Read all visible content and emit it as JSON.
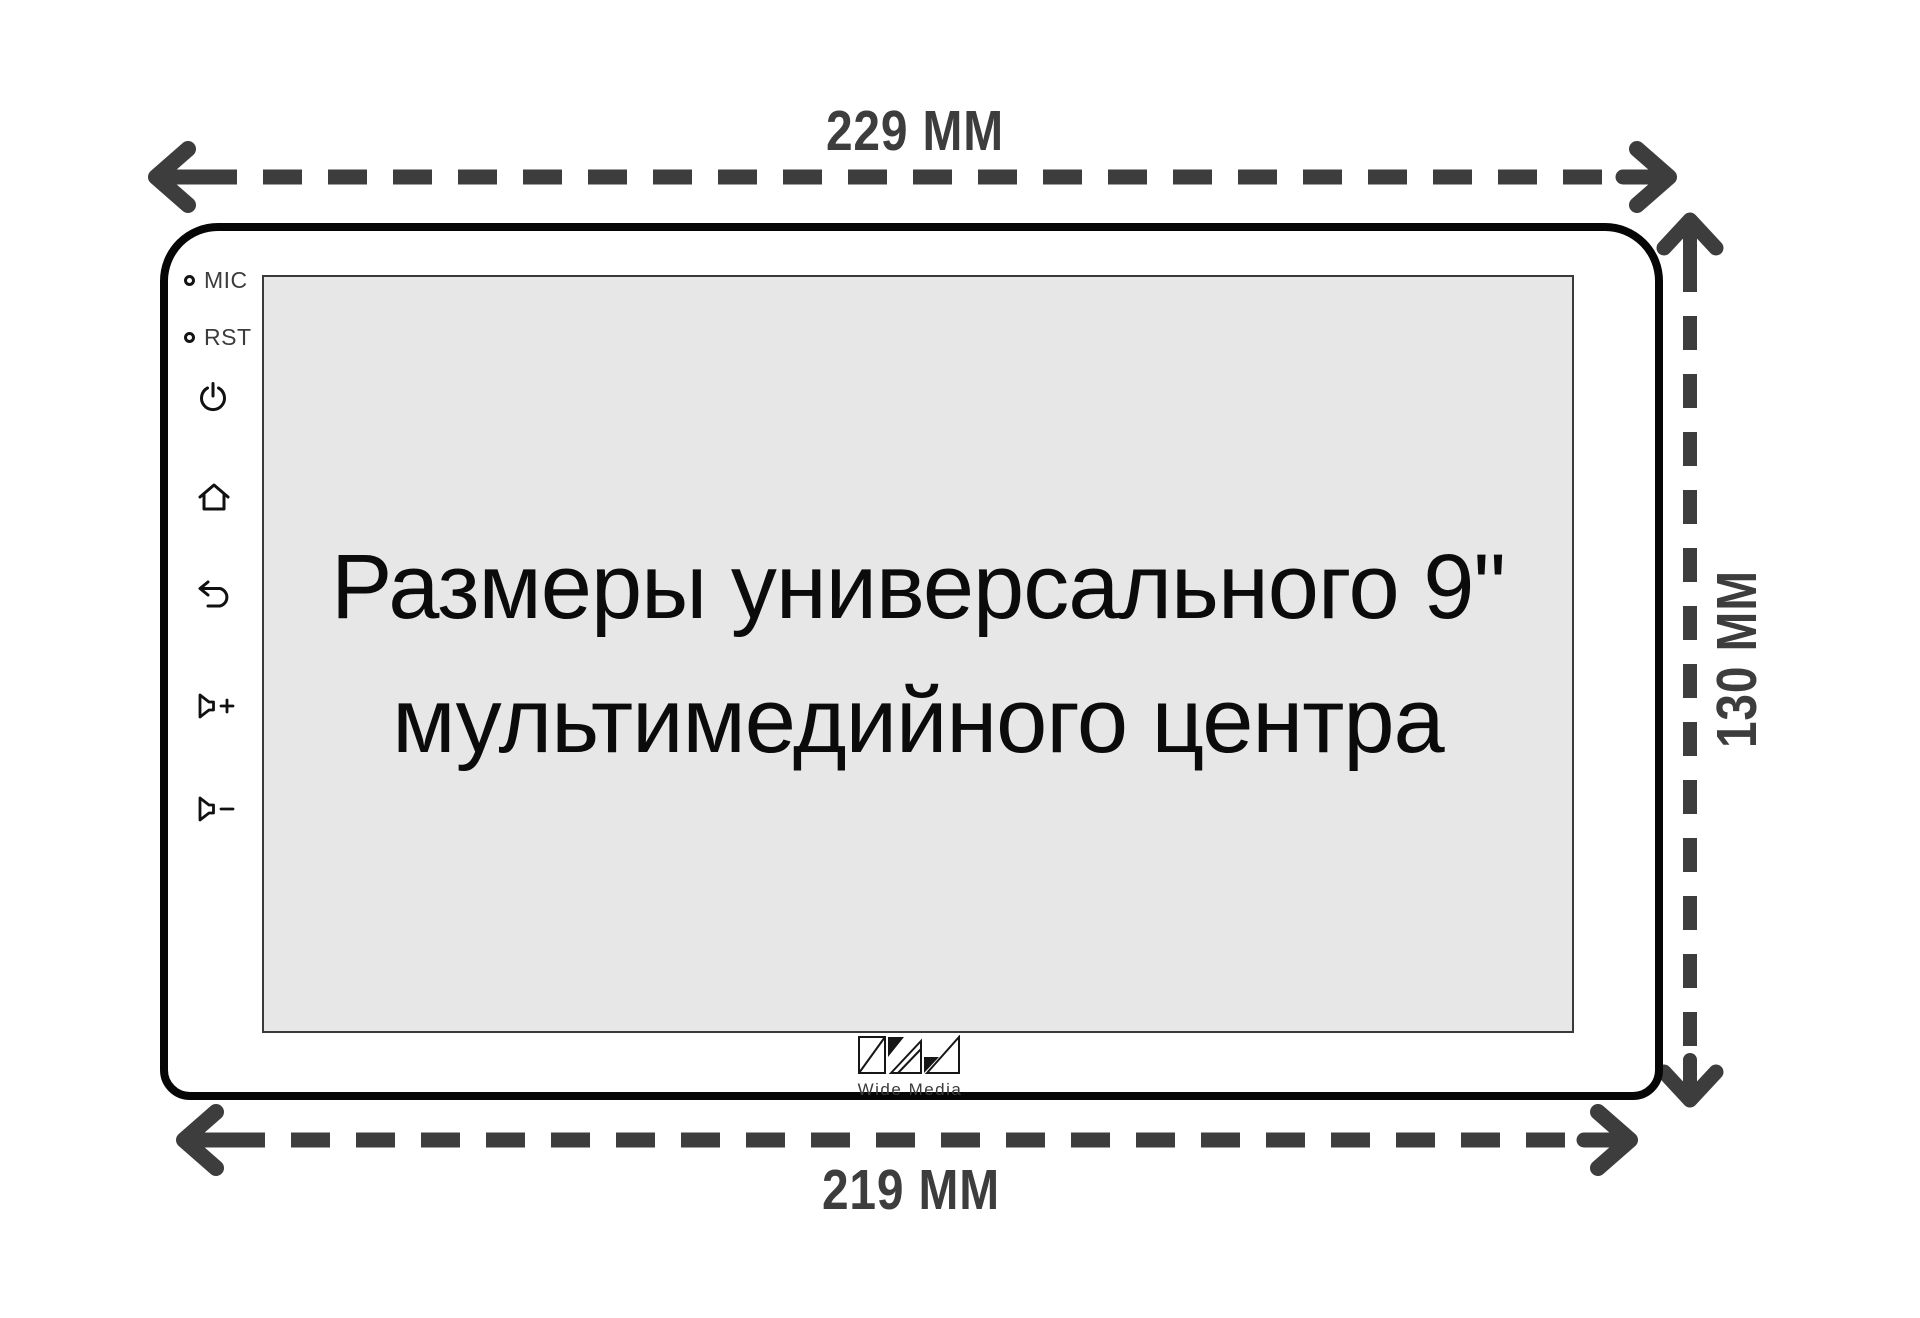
{
  "dimensions": {
    "top_label": "229 MM",
    "bottom_label": "219 MM",
    "right_label": "130 MM"
  },
  "device": {
    "port_labels": {
      "mic": "MIC",
      "rst": "RST"
    },
    "screen": {
      "title_line1": "Размеры универсального 9\"",
      "title_line2": "мультимедийного центра"
    },
    "side_buttons": [
      "power",
      "home",
      "back",
      "volume-up",
      "volume-down"
    ],
    "logo": {
      "text": "Wide Media"
    }
  },
  "icons": [
    "mic-hole-icon",
    "rst-hole-icon",
    "power-icon",
    "home-icon",
    "back-icon",
    "volume-up-icon",
    "volume-down-icon",
    "wide-media-logo-icon",
    "dimension-arrow-top",
    "dimension-arrow-bottom",
    "dimension-arrow-right"
  ],
  "colors": {
    "background": "#ffffff",
    "dimension_arrows": "#3d3d3d",
    "device_outline": "#060606",
    "screen_fill": "#e7e7e7",
    "screen_border": "#3a3a3a",
    "title_text": "#0b0b0b"
  }
}
